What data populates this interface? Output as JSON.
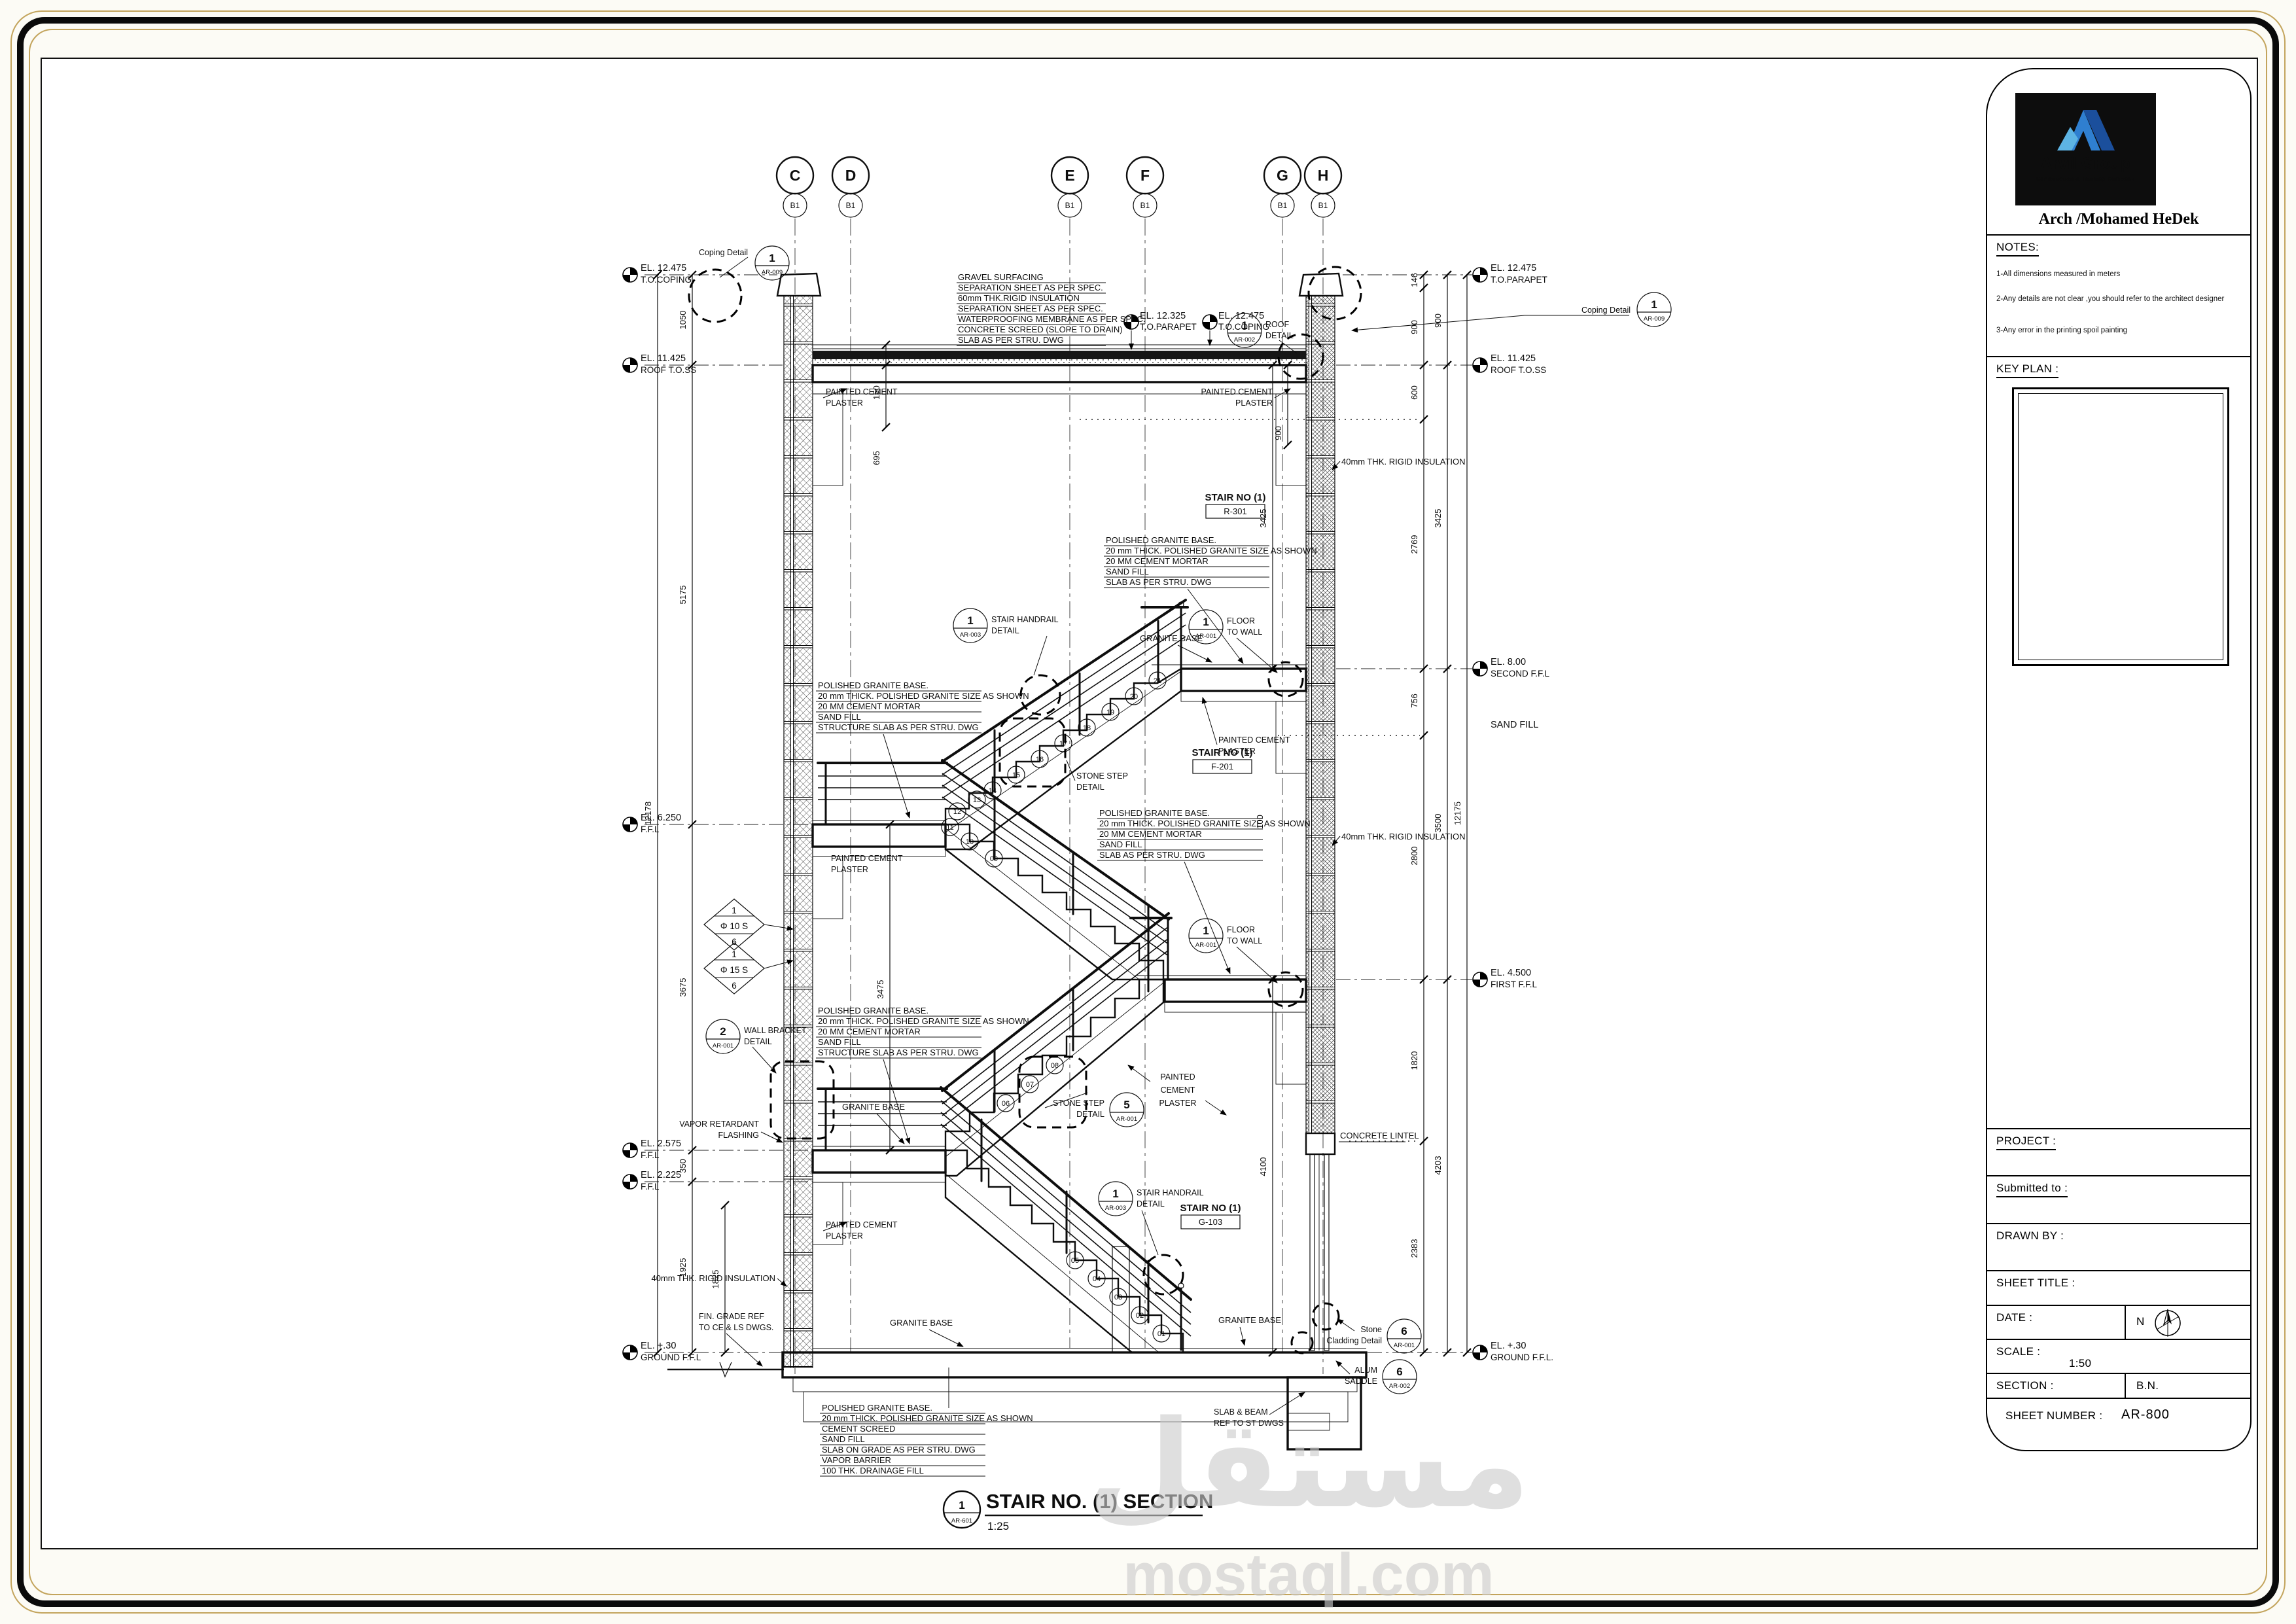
{
  "sheet": {
    "footer_num": "1",
    "footer_ref": "AR-601",
    "footer_title": "STAIR NO. (1) SECTION",
    "footer_scale": "1:25",
    "watermark_ar": "مستقل",
    "watermark_en": "mostaql.com"
  },
  "title_block": {
    "logo_title": "Arvil Group",
    "logo_subtitle": "Construction & Training Company",
    "architect": "Arch /Mohamed HeDek",
    "notes_label": "NOTES:",
    "notes": [
      "1-All dimensions measured in meters",
      "2-Any details are not clear ,you should refer to the architect designer",
      "3-Any error in the printing spoil painting"
    ],
    "key_plan_label": "KEY PLAN :",
    "project_label": "PROJECT :",
    "submitted_label": "Submitted to :",
    "drawn_by_label": "DRAWN BY :",
    "sheet_title_label": "SHEET TITLE :",
    "date_label": "DATE :",
    "north_letter": "N",
    "scale_label": "SCALE :",
    "scale_value": "1:50",
    "section_label": "SECTION :",
    "section_value": "B.N.",
    "sheet_number_label": "SHEET NUMBER :",
    "sheet_number_value": "AR-800"
  },
  "grid": [
    {
      "letter": "C",
      "sub": "B1"
    },
    {
      "letter": "D",
      "sub": "B1"
    },
    {
      "letter": "E",
      "sub": "B1"
    },
    {
      "letter": "F",
      "sub": "B1"
    },
    {
      "letter": "G",
      "sub": "B1"
    },
    {
      "letter": "H",
      "sub": "B1"
    }
  ],
  "elevations": {
    "left": [
      {
        "v": "EL. 12.475",
        "l": "T.O.COPING"
      },
      {
        "v": "EL. 11.425",
        "l": "ROOF T.O.SS"
      },
      {
        "v": "EL. 6.250",
        "l": "F.F.L"
      },
      {
        "v": "EL. 2.575",
        "l": "F.F.L"
      },
      {
        "v": "EL. 2.225",
        "l": "F.F.L"
      },
      {
        "v": "EL. +.30",
        "l": "GROUND F.F.L"
      }
    ],
    "right": [
      {
        "v": "EL. 12.475",
        "l": "T.O.PARAPET"
      },
      {
        "v": "EL. 11.425",
        "l": "ROOF T.O.SS"
      },
      {
        "v": "EL. 8.00",
        "l": "SECOND F.F.L"
      },
      {
        "v": "EL. 4.500",
        "l": "FIRST F.F.L"
      },
      {
        "v": "EL. +.30",
        "l": "GROUND F.F.L."
      }
    ],
    "top": [
      {
        "v": "EL. 12.325",
        "l": "T.O.PARAPET"
      },
      {
        "v": "EL. 12.475",
        "l": "T.O.COPING"
      }
    ]
  },
  "dims": {
    "d1050": "1050",
    "d5175": "5175",
    "d12178": "12178",
    "d3675": "3675",
    "d350": "350",
    "d1925": "1925",
    "d1825": "1825",
    "d146": "146",
    "d900": "900",
    "d600": "600",
    "d2769": "2769",
    "d756": "756",
    "d2800": "2800",
    "d1820": "1820",
    "d2383": "2383",
    "d3425": "3425",
    "d3500": "3500",
    "d4203": "4203",
    "d12175": "12175",
    "d150": "150",
    "d695": "695",
    "d3475": "3475",
    "d4100": "4100",
    "d100": "100"
  },
  "stacks": {
    "roof": [
      "GRAVEL SURFACING",
      "SEPARATION SHEET AS PER SPEC.",
      "60mm THK.RIGID INSULATION",
      "SEPARATION SHEET AS PER SPEC.",
      "WATERPROOFING MEMBRANE AS PER SPEC.",
      "CONCRETE SCREED (SLOPE TO DRAIN)",
      "SLAB  AS PER STRU. DWG"
    ],
    "floor": [
      "POLISHED GRANITE BASE.",
      "20 mm THICK. POLISHED  GRANITE SIZE  AS SHOWN",
      "20 MM CEMENT MORTAR",
      "SAND FILL",
      "SLAB  AS PER STRU. DWG"
    ],
    "landing": [
      "POLISHED GRANITE BASE.",
      "20 mm THICK. POLISHED  GRANITE SIZE  AS SHOWN",
      "20 MM CEMENT MORTAR",
      "SAND FILL",
      "STRUCTURE SLAB AS PER STRU. DWG"
    ],
    "ground": [
      "POLISHED GRANITE BASE.",
      "20 mm THICK. POLISHED  GRANITE SIZE  AS SHOWN",
      "CEMENT SCREED",
      "SAND FILL",
      "SLAB ON GRADE AS PER STRU. DWG",
      "VAPOR  BARRIER",
      "100 THK.   DRAINAGE FILL"
    ]
  },
  "labels": {
    "painted1": "PAINTED CEMENT",
    "painted2": "PLASTER",
    "painted_a": "PAINTED",
    "painted_b": "CEMENT",
    "painted_c": "PLASTER",
    "granite": "GRANITE BASE",
    "sand": "SAND FILL",
    "lintel": "CONCRETE LINTEL",
    "insul": "40mm THK. RIGID INSULATION",
    "vapor1": "VAPOR RETARDANT",
    "vapor2": "FLASHING",
    "fin1": "FIN. GRADE REF",
    "fin2": "TO CE & LS DWGS.",
    "sb1": "SLAB & BEAM",
    "sb2": "REF TO ST DWGS",
    "coping": "Coping Detail",
    "stone1": "Stone",
    "stone2": "Cladding Detail",
    "alum1": "ALUM",
    "alum2": "SADDLE",
    "stair_no": "STAIR NO (1)",
    "r301": "R-301",
    "f201": "F-201",
    "g103": "G-103",
    "ss1": "STONE STEP",
    "ss2": "DETAIL",
    "hr1": "STAIR HANDRAIL",
    "hr2": "DETAIL",
    "fw1": "FLOOR",
    "fw2": "TO WALL",
    "wb1": "WALL BRACKET",
    "wb2": "DETAIL",
    "rd1": "ROOF",
    "rd2": "DETAIL",
    "n1": "1",
    "n2": "2",
    "n5": "5",
    "n6": "6",
    "ar001": "AR-001",
    "ar002": "AR-002",
    "ar003": "AR-003",
    "ar009": "AR-009",
    "dia_top": "1",
    "dia10": "Φ 10 S",
    "dia15": "Φ 15 S",
    "dia_bot": "6"
  },
  "steps": [
    "01",
    "02",
    "03",
    "04",
    "05",
    "06",
    "07",
    "08",
    "09",
    "10",
    "11",
    "12",
    "13",
    "14",
    "15",
    "16",
    "17",
    "18",
    "19",
    "20",
    "21"
  ]
}
